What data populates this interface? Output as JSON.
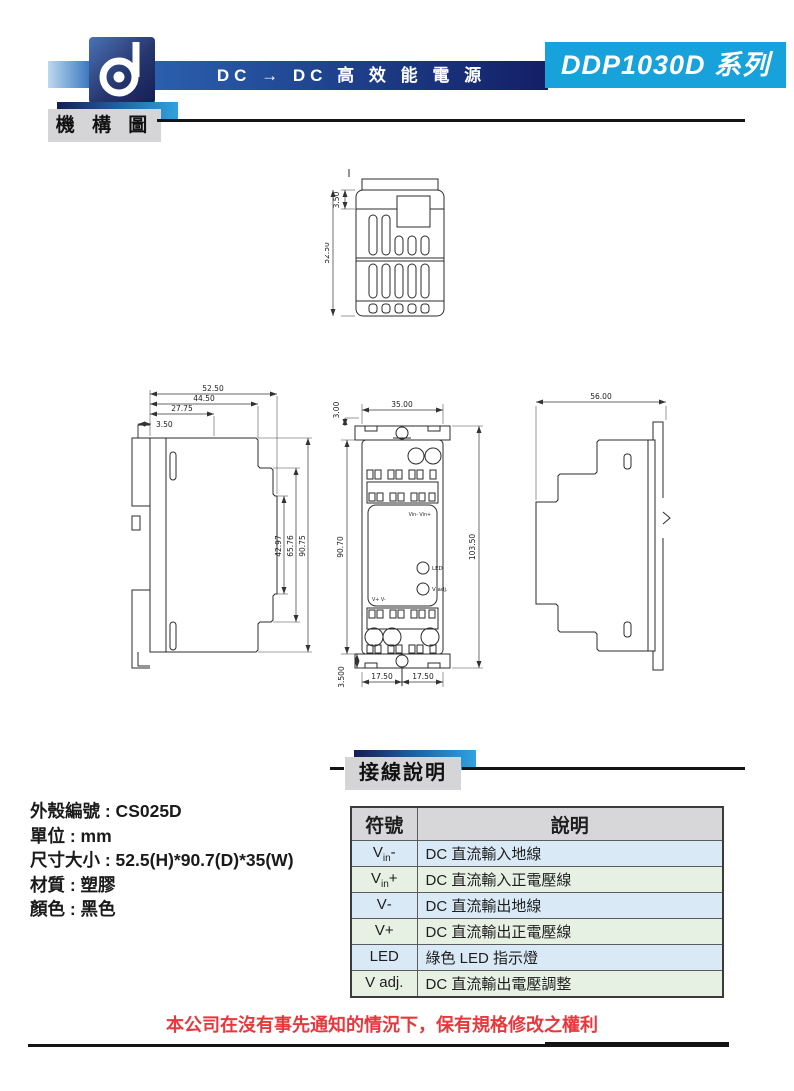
{
  "header": {
    "logo": "d",
    "product_line": "DC → DC 高 效 能 電 源",
    "series": "DDP1030D 系列"
  },
  "sections": {
    "mechanism": "機 構 圖",
    "wiring": "接線說明"
  },
  "dims": {
    "top_view": {
      "lip": "3.50",
      "height": "52.50"
    },
    "left_view": {
      "w1": "52.50",
      "w2": "44.50",
      "w3": "27.75",
      "w4": "3.50",
      "h1": "42.97",
      "h2": "65.76",
      "h3": "90.75"
    },
    "front_view": {
      "t": "3.00",
      "w": "35.00",
      "hl": "90.70",
      "hr": "103.50",
      "b": "3.500",
      "b1": "17.50",
      "b2": "17.50"
    },
    "right_view": {
      "w": "56.00"
    }
  },
  "front_labels": {
    "top": "Vin- Vin+",
    "led": "LED",
    "vadj": "V adj.",
    "bottom": "V+  V-"
  },
  "product_info": {
    "lines": [
      "外殼編號 : CS025D",
      "單位 : mm",
      "尺寸大小 : 52.5(H)*90.7(D)*35(W)",
      "材質 : 塑膠",
      "顏色 : 黑色"
    ]
  },
  "wiring_table": {
    "col_symbol": "符號",
    "col_desc": "說明",
    "rows": [
      {
        "sym": {
          "pre": "V",
          "sub": "in",
          "post": "-"
        },
        "desc": "DC 直流輸入地線"
      },
      {
        "sym": {
          "pre": "V",
          "sub": "in",
          "post": "+"
        },
        "desc": "DC 直流輸入正電壓線"
      },
      {
        "sym": {
          "pre": "V",
          "sub": "",
          "post": "-"
        },
        "desc": "DC 直流輸出地線"
      },
      {
        "sym": {
          "pre": "V",
          "sub": "",
          "post": "+"
        },
        "desc": "DC 直流輸出正電壓線"
      },
      {
        "sym": {
          "pre": "LED",
          "sub": "",
          "post": ""
        },
        "desc": "綠色 LED 指示燈"
      },
      {
        "sym": {
          "pre": "V adj.",
          "sub": "",
          "post": ""
        },
        "desc": "DC 直流輸出電壓調整"
      }
    ]
  },
  "disclaimer": "本公司在沒有事先通知的情況下，保有規格修改之權利",
  "colors": {
    "navy": "#141e54",
    "cyan": "#17a2dc",
    "red": "#e8383d",
    "row_blue": "#d9eaf6",
    "row_green": "#e7f1e3",
    "label_gray": "#d5d5d7"
  }
}
